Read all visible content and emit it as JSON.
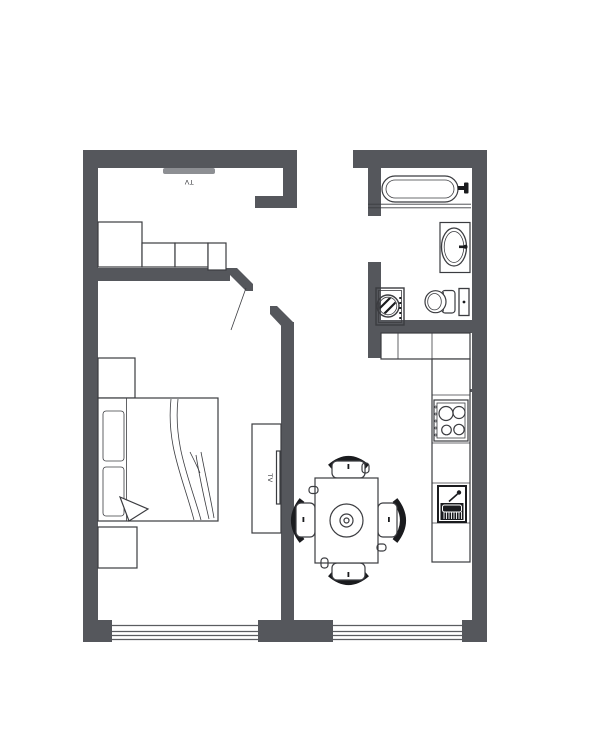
{
  "colors": {
    "paper": "#ffffff",
    "wall": "#55575c",
    "line": "#3b3c40",
    "dark": "#1a1b1e",
    "tvbar": "#8d8f93",
    "glass": "#5a5c60"
  },
  "labels": {
    "wall_tv": "TV",
    "stand_tv": "TV"
  },
  "rooms": [
    "bedroom-living-area",
    "entry-hall",
    "bathroom",
    "kitchen-dining-area"
  ],
  "fixtures": [
    "wall-tv",
    "wardrobe",
    "bed",
    "nightstands",
    "tv-stand",
    "door-swing",
    "dining-table",
    "dining-chairs",
    "kitchen-cabinets",
    "stove",
    "kitchen-sink",
    "bathtub",
    "bathroom-sink",
    "washing-machine",
    "toilet",
    "flush-panel",
    "windows"
  ]
}
